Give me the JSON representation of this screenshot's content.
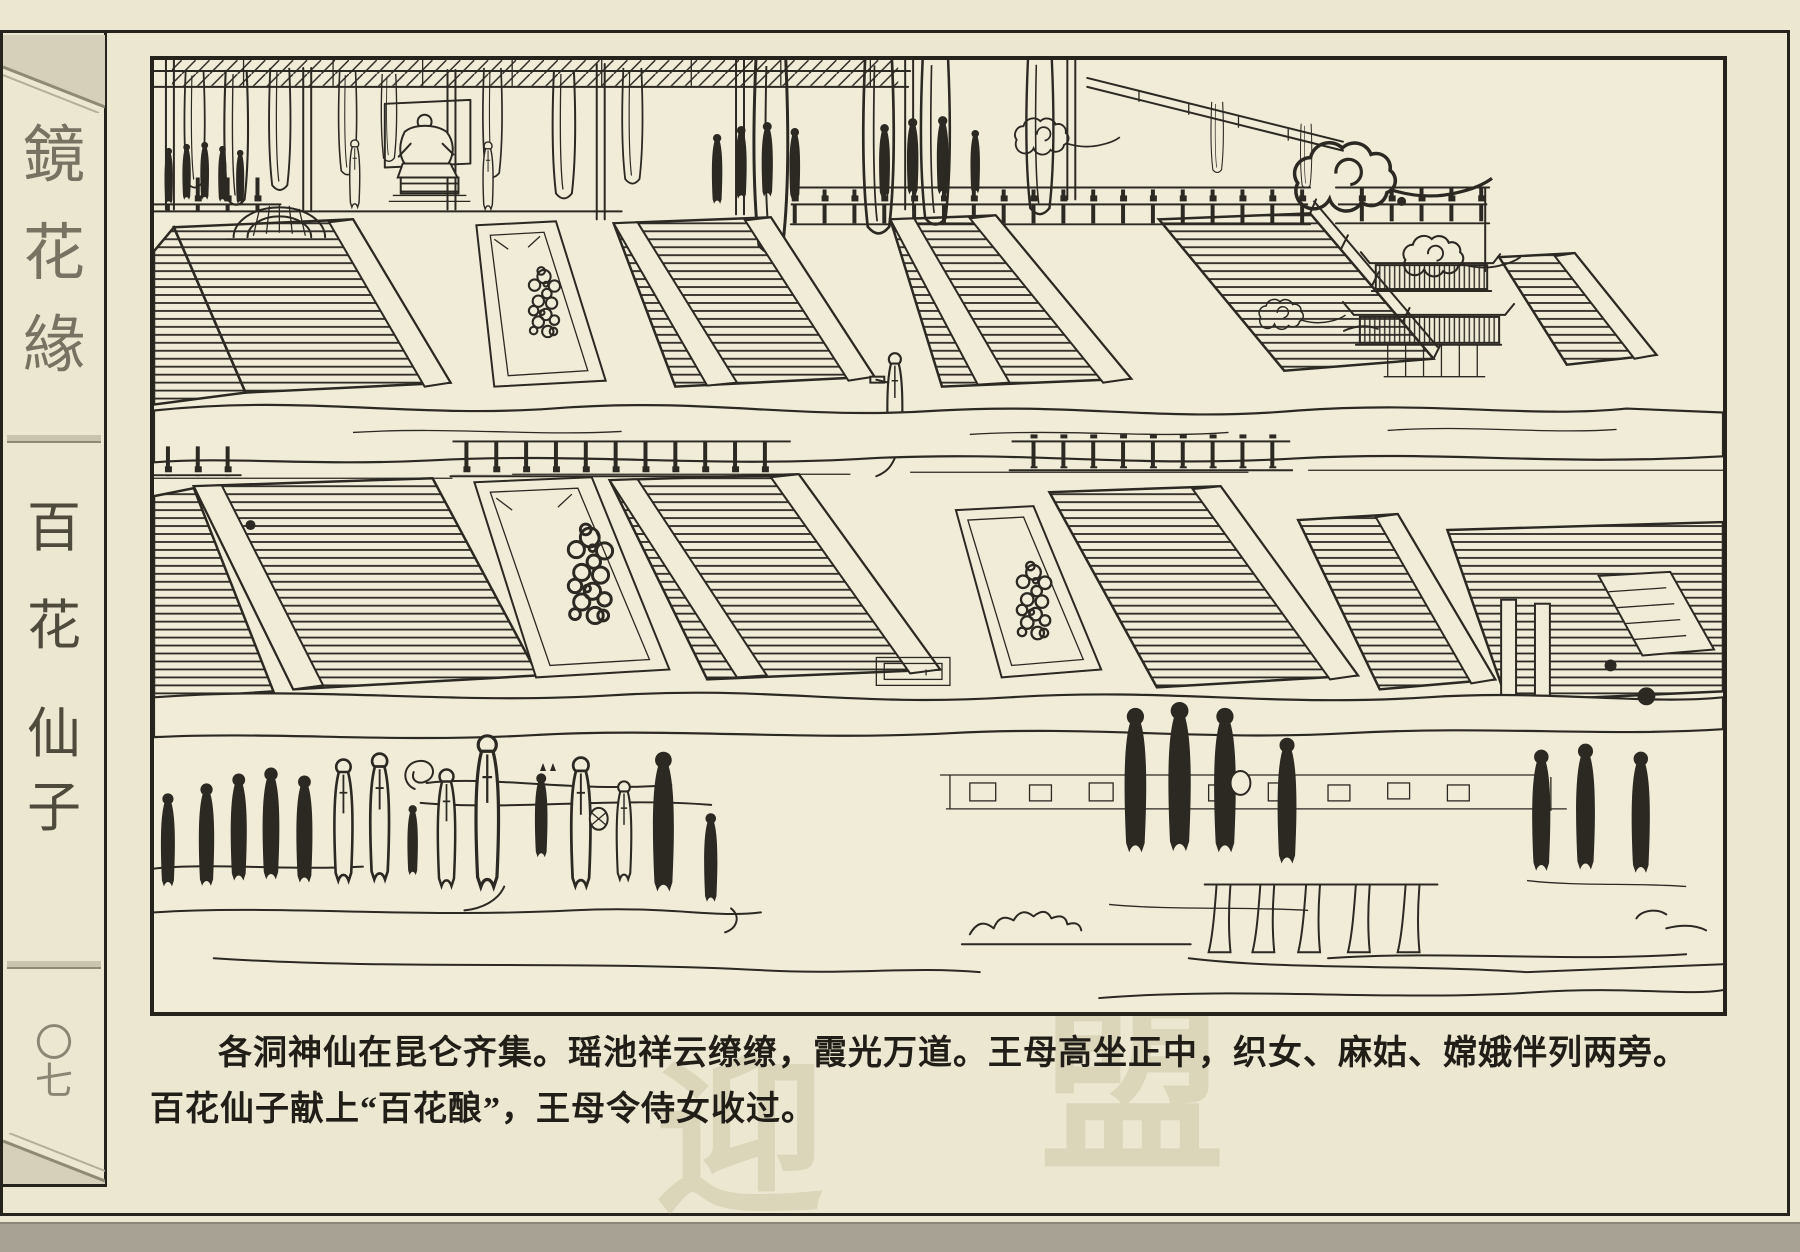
{
  "colors": {
    "paper": "#ece7d1",
    "panel_paper": "#f0ecd8",
    "ink": "#2c2822",
    "border": "#26231c",
    "sidebar_series_ink": "#6e6958",
    "sidebar_episode_ink": "#4f4b3c",
    "sidebar_pageno_ink": "#8b8674",
    "page_edge": "#a7a294",
    "corner_decoration": "#d6d0ba",
    "watermark": "#a89a6e"
  },
  "sidebar": {
    "series_title": "鏡花緣",
    "series_chars": [
      "鏡",
      "花",
      "緣"
    ],
    "episode_title": "百花仙子",
    "episode_chars": [
      "百",
      "花",
      "仙",
      "子"
    ],
    "page_number": "〇七",
    "page_number_chars": [
      "〇",
      "七"
    ]
  },
  "caption": {
    "line1": "各洞神仙在昆仑齐集。瑶池祥云缭缭，霞光万道。王母高坐正中，织女、麻姑、嫦娥伴列两旁。",
    "line2": "百花仙子献上“百花酿”，王母令侍女收过。"
  },
  "watermark": {
    "chars": [
      "迎",
      "盟"
    ]
  }
}
